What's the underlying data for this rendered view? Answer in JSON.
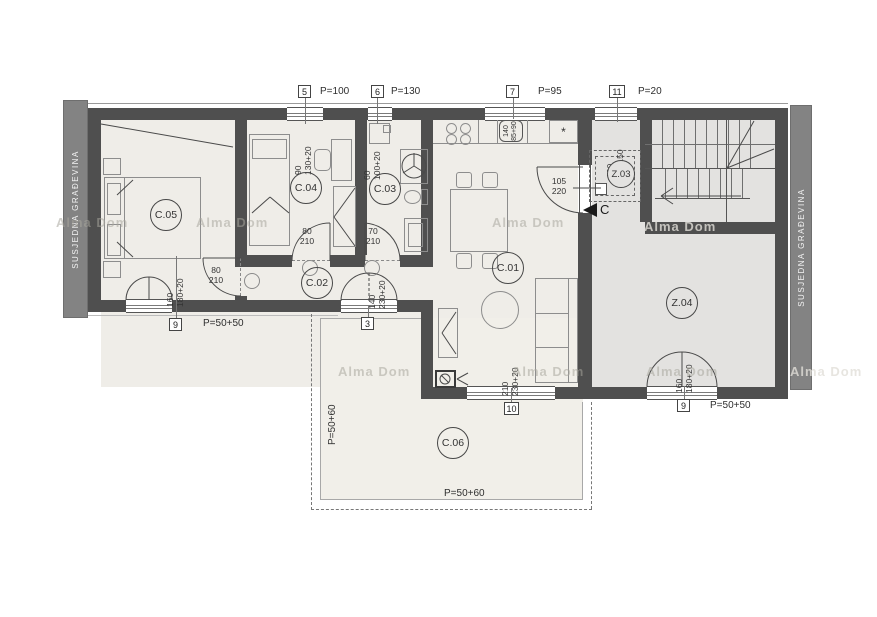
{
  "neighbors": {
    "left": "SUSJEDNA GRAĐEVINA",
    "right": "SUSJEDNA GRAĐEVINA"
  },
  "watermark": {
    "text": "Alma Dom"
  },
  "rooms": {
    "c01": "C.01",
    "c02": "C.02",
    "c03": "C.03",
    "c04": "C.04",
    "c05": "C.05",
    "c06": "C.06",
    "z03": "Z.03",
    "z04": "Z.04"
  },
  "tags": {
    "t5": {
      "num": "5",
      "p": "P=100",
      "w": "90",
      "h": "130+20"
    },
    "t6": {
      "num": "6",
      "p": "P=130",
      "w": "60",
      "h": "100+20"
    },
    "t7": {
      "num": "7",
      "p": "P=95",
      "w": "140",
      "h": "85+90"
    },
    "t11": {
      "num": "11",
      "p": "P=20",
      "w": "100",
      "h": "80+150"
    },
    "t9l": {
      "num": "9",
      "p": "P=50+50",
      "w": "160",
      "h": "180+20"
    },
    "t3": {
      "num": "3",
      "w": "140",
      "h": "230+20"
    },
    "t10": {
      "num": "10",
      "w": "210",
      "h": "230+20"
    },
    "t9r": {
      "num": "9",
      "p": "P=50+50",
      "w": "160",
      "h": "180+20"
    }
  },
  "doors": {
    "c05": {
      "w": "80",
      "h": "210"
    },
    "c04": {
      "w": "80",
      "h": "210"
    },
    "c03": {
      "w": "70",
      "h": "210"
    },
    "entry": {
      "w": "105",
      "h": "220"
    }
  },
  "terrace": {
    "left": "P=50+60",
    "bottom": "P=50+60"
  },
  "section": {
    "letter": "C"
  },
  "kitchen": {
    "appliance_mark": "*"
  },
  "colors": {
    "wall": "#4f4f4f",
    "room": "#efede8",
    "common": "#e3e2e0",
    "strip": "#838383"
  }
}
